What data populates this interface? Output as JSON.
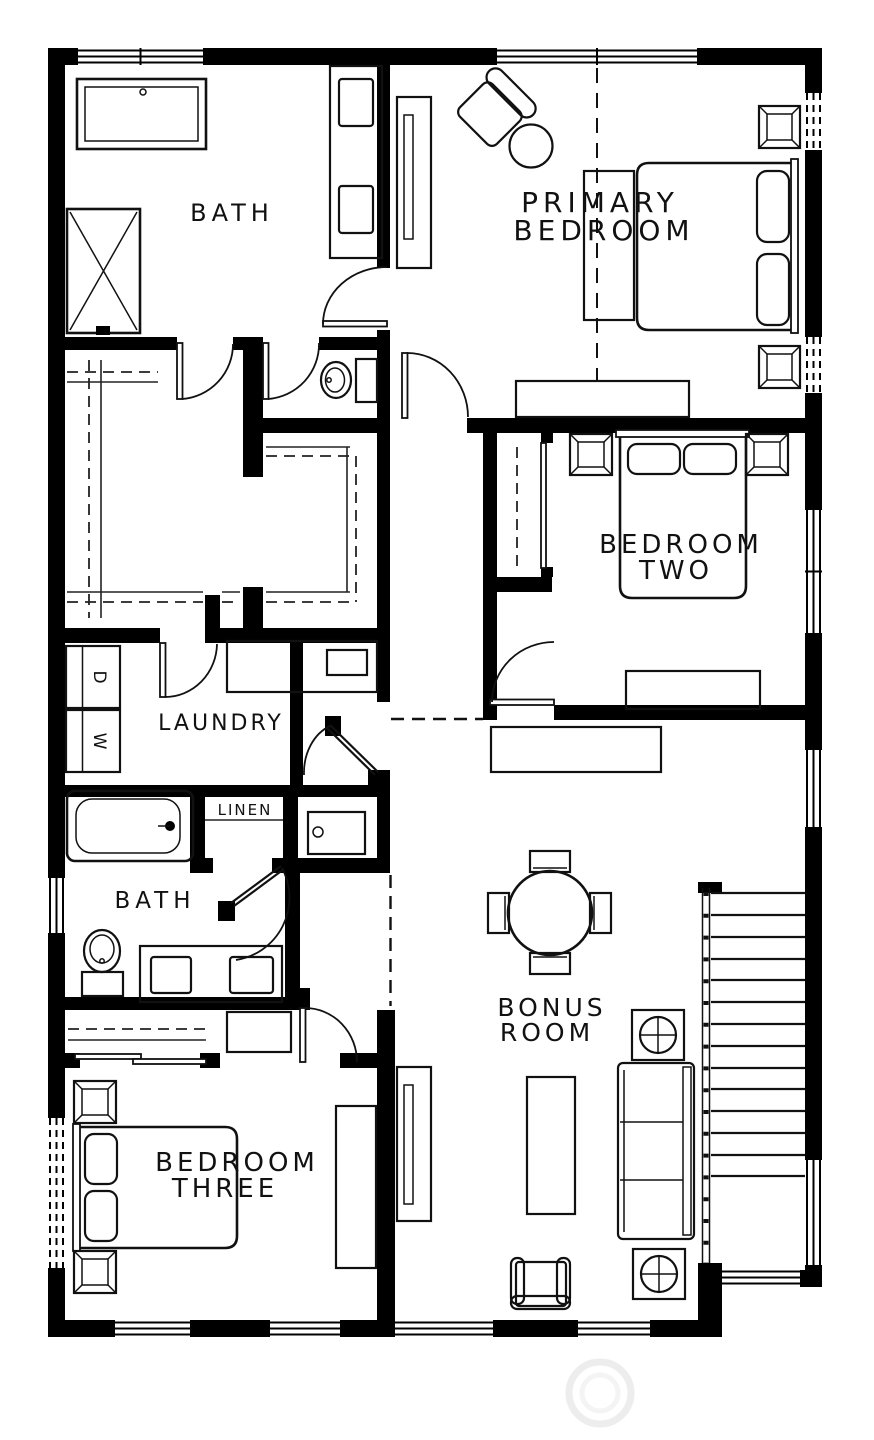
{
  "plan": {
    "rooms": {
      "bath_primary": {
        "label": "BATH"
      },
      "primary_bedroom": {
        "line1": "PRIMARY",
        "line2": "BEDROOM"
      },
      "bedroom_two": {
        "line1": "BEDROOM",
        "line2": "TWO"
      },
      "laundry": {
        "label": "LAUNDRY"
      },
      "linen": {
        "label": "LINEN"
      },
      "bath_hall": {
        "label": "BATH"
      },
      "bonus_room": {
        "line1": "BONUS",
        "line2": "ROOM"
      },
      "bedroom_three": {
        "line1": "BEDROOM",
        "line2": "THREE"
      }
    },
    "appliances": {
      "washer": "W",
      "dryer": "D"
    },
    "fixtures": [
      "bathtub",
      "shower",
      "double-sink-vanity",
      "toilet",
      "walk-in-closet-rods",
      "stacked-washer-dryer",
      "laundry-counter-sink",
      "linen-shelf",
      "wet-bar-sink",
      "bed",
      "pillows",
      "nightstand",
      "dresser",
      "desk",
      "accent-chair",
      "round-side-table",
      "dining-table-4-chairs",
      "sofa",
      "coffee-table",
      "media-console",
      "armchair",
      "staircase-with-railing",
      "window",
      "door-swing"
    ],
    "colors": {
      "wall": "#000000",
      "line": "#111111",
      "background": "#ffffff",
      "watermark": "#ededed"
    }
  }
}
